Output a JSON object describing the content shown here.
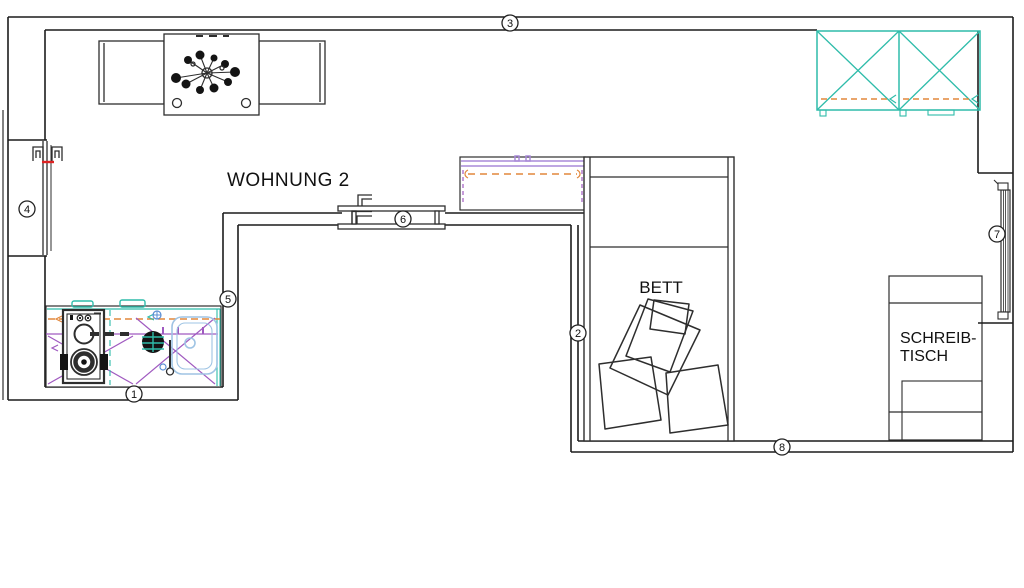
{
  "title": "WOHNUNG 2",
  "labels": {
    "apartment": "WOHNUNG 2",
    "bed": "BETT",
    "desk_line1": "SCHREIB-",
    "desk_line2": "TISCH"
  },
  "markers": [
    {
      "id": 1,
      "label": "1"
    },
    {
      "id": 2,
      "label": "2"
    },
    {
      "id": 3,
      "label": "3"
    },
    {
      "id": 4,
      "label": "4"
    },
    {
      "id": 5,
      "label": "5"
    },
    {
      "id": 6,
      "label": "6"
    },
    {
      "id": 7,
      "label": "7"
    },
    {
      "id": 8,
      "label": "8"
    }
  ],
  "colors": {
    "wall": "#1c1c1c",
    "furniture": "#2e2e2e",
    "teal": "#2fbcaa",
    "orange": "#e2873b",
    "purple": "#a05ac0",
    "violet": "#a98ad8",
    "blue": "#5b8fd4",
    "lightblue": "#9fc4e4",
    "red": "#dd2222"
  }
}
